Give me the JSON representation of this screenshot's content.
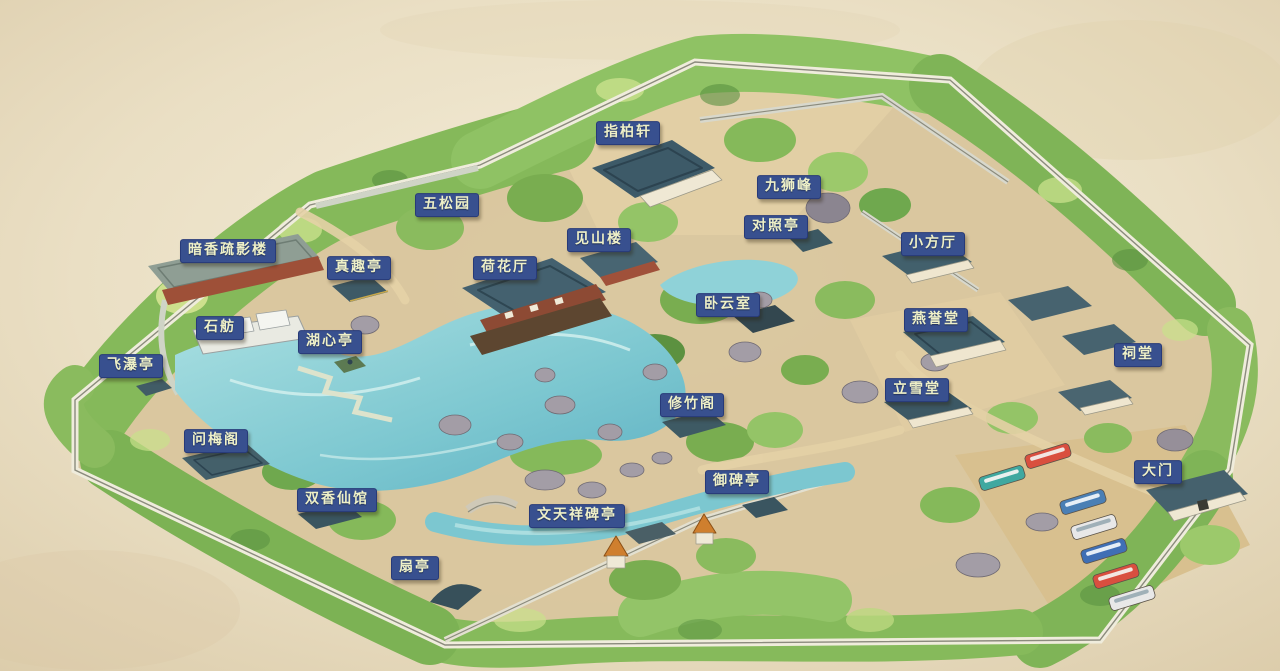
{
  "map": {
    "colors": {
      "paper": "#eadfc6",
      "canopy": "#8abb5e",
      "water": "#7cc7d0",
      "label_bg": "#38508f",
      "label_border": "#273a78",
      "label_text": "#eef0c8"
    },
    "labels": [
      {
        "text": "指柏轩",
        "x": 628,
        "y": 133
      },
      {
        "text": "九狮峰",
        "x": 789,
        "y": 187
      },
      {
        "text": "五松园",
        "x": 447,
        "y": 205
      },
      {
        "text": "对照亭",
        "x": 776,
        "y": 227
      },
      {
        "text": "小方厅",
        "x": 933,
        "y": 244
      },
      {
        "text": "见山楼",
        "x": 599,
        "y": 240
      },
      {
        "text": "暗香疏影楼",
        "x": 228,
        "y": 251
      },
      {
        "text": "真趣亭",
        "x": 359,
        "y": 268
      },
      {
        "text": "荷花厅",
        "x": 505,
        "y": 268
      },
      {
        "text": "卧云室",
        "x": 728,
        "y": 305
      },
      {
        "text": "燕誉堂",
        "x": 936,
        "y": 320
      },
      {
        "text": "石舫",
        "x": 220,
        "y": 328
      },
      {
        "text": "湖心亭",
        "x": 330,
        "y": 342
      },
      {
        "text": "祠堂",
        "x": 1138,
        "y": 355
      },
      {
        "text": "飞瀑亭",
        "x": 131,
        "y": 366
      },
      {
        "text": "立雪堂",
        "x": 917,
        "y": 390
      },
      {
        "text": "修竹阁",
        "x": 692,
        "y": 405
      },
      {
        "text": "问梅阁",
        "x": 216,
        "y": 441
      },
      {
        "text": "御碑亭",
        "x": 737,
        "y": 482
      },
      {
        "text": "双香仙馆",
        "x": 337,
        "y": 500
      },
      {
        "text": "文天祥碑亭",
        "x": 577,
        "y": 516
      },
      {
        "text": "大门",
        "x": 1158,
        "y": 472
      },
      {
        "text": "扇亭",
        "x": 415,
        "y": 568
      }
    ]
  }
}
